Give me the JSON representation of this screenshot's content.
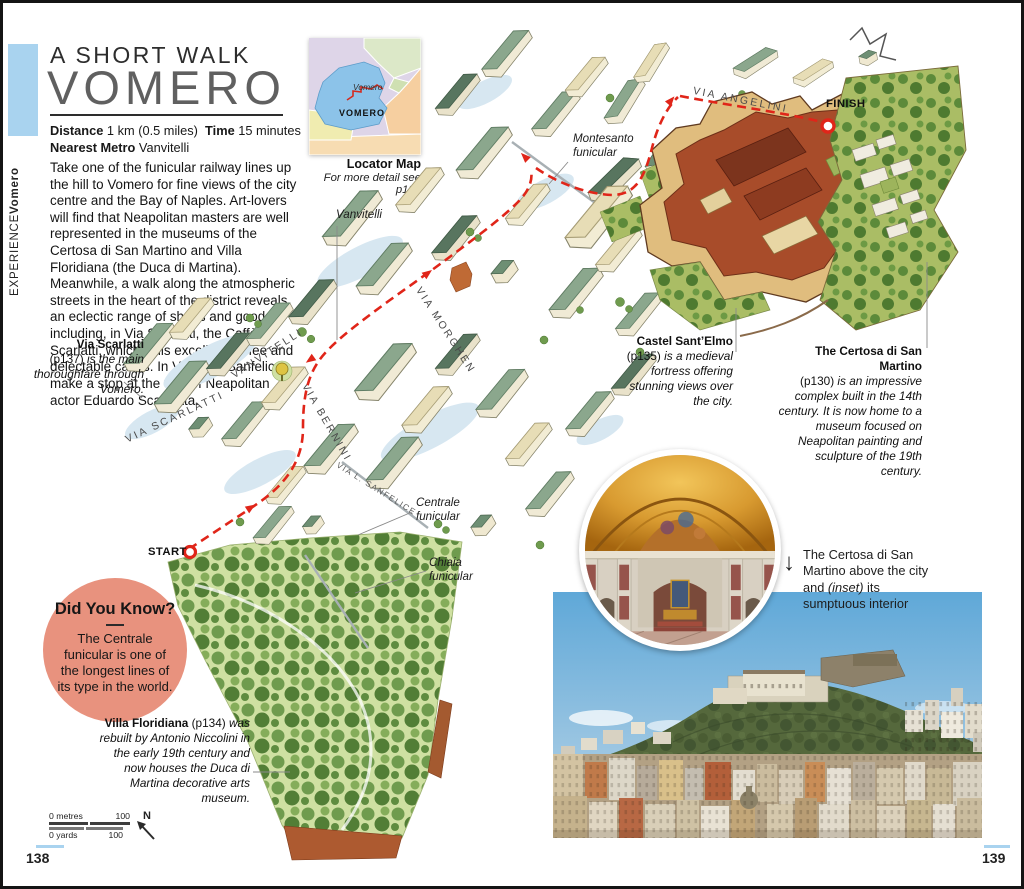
{
  "sidebar": {
    "section": "EXPERIENCE",
    "chapter": "Vomero"
  },
  "header": {
    "kicker": "A SHORT WALK",
    "title": "VOMERO",
    "meta": {
      "distance_label": "Distance",
      "distance_value": "1 km (0.5 miles)",
      "time_label": "Time",
      "time_value": "15 minutes",
      "metro_label": "Nearest Metro",
      "metro_value": "Vanvitelli"
    }
  },
  "intro": {
    "text": "Take one of the funicular railway lines up the hill to Vomero for fine views of the city centre and the Bay of Naples. Art-lovers will find that Neapolitan masters are well represented in the museums of the Certosa di San Martino and Villa Floridiana (the Duca di Martina). Meanwhile, a walk along the atmospheric streets in the heart of the district reveals an eclectic range of shops and goods, including, in Via Scarlatti, the Caffè Scarlatti, which sells excellent coffee and delectable cakes. In Via Luigi Sanfelice, make a stop at the villa of Neapolitan actor Eduardo Scarpetta."
  },
  "locator": {
    "region_label_italic": "Vomero",
    "region_label": "VOMERO",
    "caption_title": "Locator Map",
    "caption_subtitle": "For more detail see p126"
  },
  "map": {
    "streets": {
      "scarlatti": "VIA SCARLATTI",
      "vanvitelli": "VANVITELLI",
      "bernini": "VIA BERNINI",
      "morghen": "VIA MORGHEN",
      "sanfelice": "VIA L. SANFELICE",
      "angelini": "VIA ANGELINI"
    },
    "labels": {
      "vanvitelli_metro": "Vanvitelli",
      "montesanto": "Montesanto funicular",
      "centrale": "Centrale funicular",
      "chiaia": "Chiaia funicular"
    },
    "markers": {
      "start": "START",
      "finish": "FINISH"
    }
  },
  "annotations": {
    "via_scarlatti": {
      "title": "Via Scarlatti",
      "ref": "(p137)",
      "body": "is the main thoroughfare through Vomero."
    },
    "castel_sant_elmo": {
      "title": "Castel Sant’Elmo",
      "ref": "(p135)",
      "body": "is a medieval fortress offering stunning views over the city."
    },
    "certosa": {
      "title": "The Certosa di San Martino",
      "ref": "(p130)",
      "body": "is an impressive complex built in the 14th century. It is now home to a museum focused on Neapolitan painting and sculpture of the 19th century."
    },
    "villa_floridiana": {
      "title": "Villa Floridiana",
      "ref": "(p134)",
      "body": "was rebuilt by Antonio Niccolini in the early 19th century and now houses the Duca di Martina decorative arts museum."
    }
  },
  "did_you_know": {
    "title": "Did You Know?",
    "body": "The Centrale funicular is one of the longest lines of its type in the world."
  },
  "photo_caption": {
    "before": "The Certosa di San Martino above the city and ",
    "inset": "(inset)",
    "after": " its sumptuous interior"
  },
  "scale_bar": {
    "metres_start": "0 metres",
    "metres_end": "100",
    "yards_start": "0 yards",
    "yards_end": "100",
    "compass": "N"
  },
  "page_numbers": {
    "left": "138",
    "right": "139"
  },
  "colors": {
    "accent_route_red": "#e02519",
    "sidebar_tab_blue": "#a9d3ef",
    "did_you_know_salmon": "#e8927e",
    "locator_vomero_blue": "#8cc3e9",
    "map_roof_green": "#8ba78d",
    "fortress_red_brown": "#a84c2a",
    "park_green": "#cfe0a2",
    "page_number_line_blue": "#a9d3ef"
  }
}
